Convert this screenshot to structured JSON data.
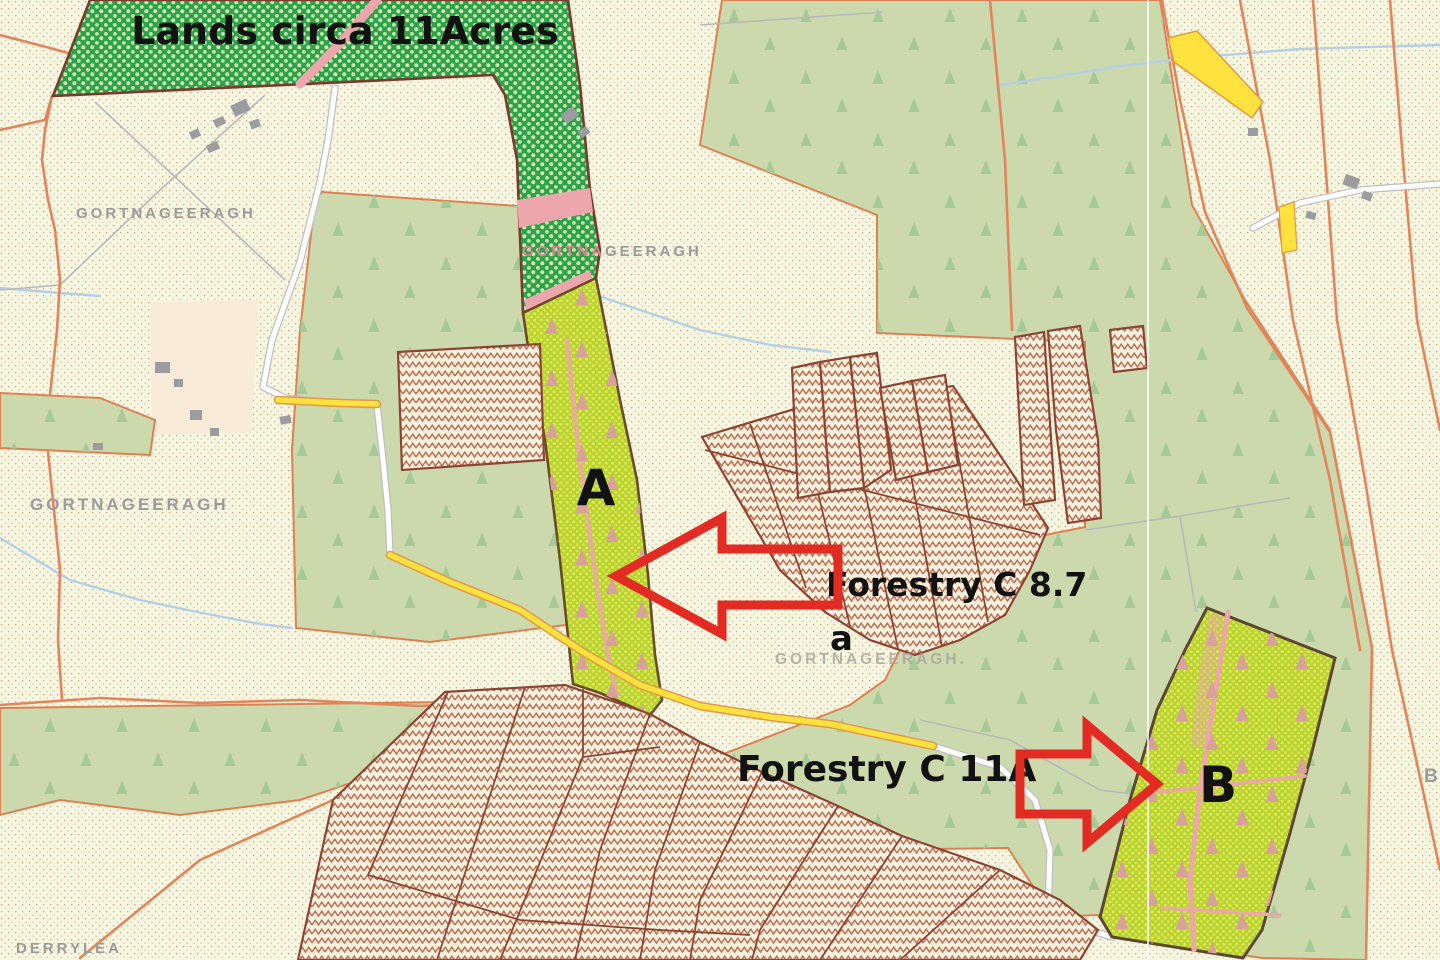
{
  "annotations": {
    "lands_label": "Lands circa 11Acres",
    "parcel_a_letter": "A",
    "forestry_c87_label": "Forestry C 8.7",
    "forestry_c87_sub": "a",
    "forestry_c11a_label": "Forestry C 11A",
    "parcel_b_letter": "B"
  },
  "townlands": {
    "northwest": "GORTNAGEERAGH",
    "west": "GORTNAGEERAGH",
    "strip_part1": "GORTNA",
    "strip_part2": "GEERAGH",
    "center": "GORTNAGEERAGH.",
    "southwest": "DERRYLEA",
    "east_partial": "B"
  },
  "legend_colors": {
    "background_cream": "#f5f7e0",
    "forest_sage": "#ccd9ad",
    "parcel_dark_green": "#2aa34b",
    "parcel_chartreuse": "#b7d334",
    "hatch_red_brown": "#b5563f",
    "boundary_orange": "#e2855c",
    "road_yellow": "#ffe23e",
    "road_white": "#ffffff",
    "stream_blue": "#b5cfe4",
    "arrow_red": "#e22b22",
    "townland_gray": "#9b9b9b",
    "pink_track": "#eca6ac",
    "annotation_black": "#111111"
  }
}
